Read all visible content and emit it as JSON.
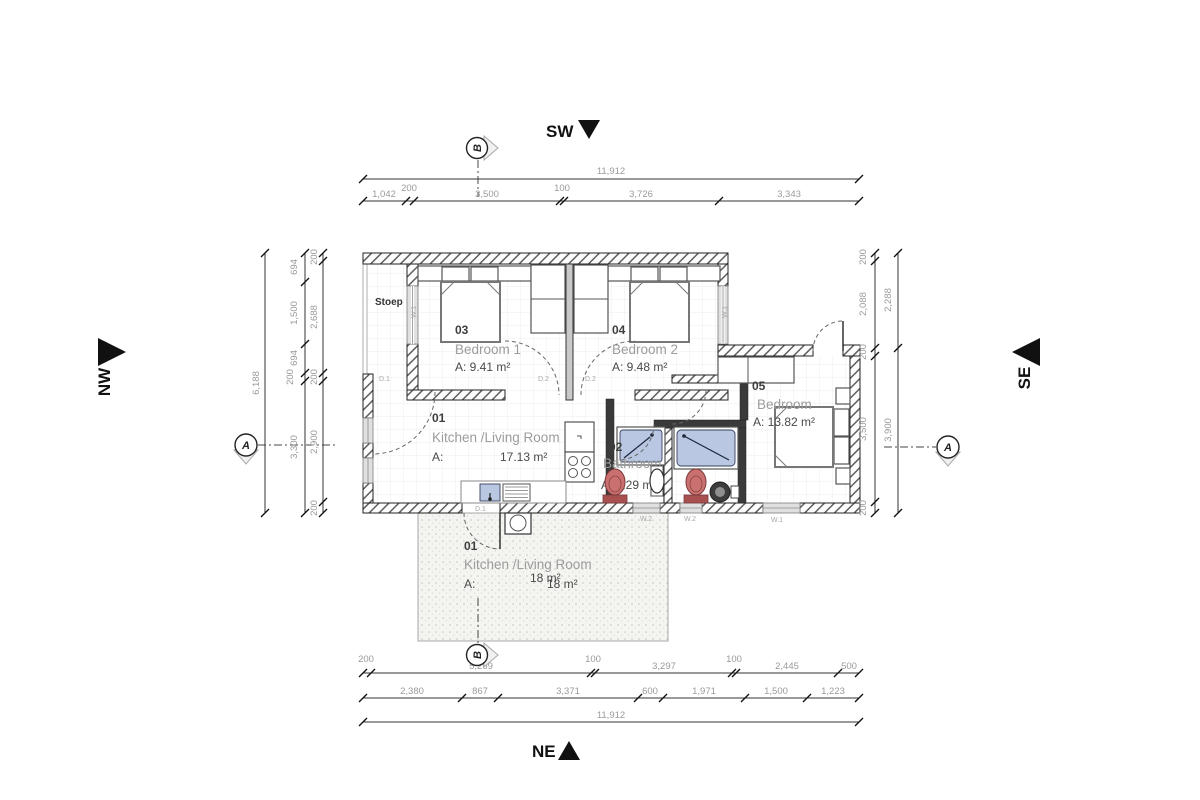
{
  "compass": {
    "sw": "SW",
    "ne": "NE",
    "nw": "NW",
    "se": "SE"
  },
  "section_markers": {
    "top": "B",
    "bottom": "B",
    "left": "A",
    "right": "A"
  },
  "dims": {
    "top": {
      "total": "11,912",
      "minor": [
        "200",
        "100"
      ],
      "segments": [
        "1,042",
        "3,500",
        "3,726",
        "3,343"
      ]
    },
    "bottom": {
      "row1": [
        "200",
        "5,269",
        "100",
        "3,297",
        "100",
        "2,445",
        "500"
      ],
      "row2": [
        "2,380",
        "867",
        "3,371",
        "600",
        "1,971",
        "1,500",
        "1,223"
      ],
      "total": "11,912"
    },
    "left": {
      "total": "6,188",
      "mid": [
        "694",
        "1,500",
        "694",
        "200",
        "3,300"
      ],
      "inner": [
        "200",
        "2,688",
        "200",
        "2,900",
        "200"
      ]
    },
    "right": {
      "inner": [
        "200",
        "2,088",
        "200",
        "3,500",
        "200"
      ],
      "outer": [
        "2,288",
        "3,900"
      ]
    }
  },
  "rooms": {
    "kitchen": {
      "number": "01",
      "name": "Kitchen /Living Room",
      "area_prefix": "A:",
      "area": "17.13 m²"
    },
    "bathroom": {
      "number": "02",
      "name": "Bathroom",
      "area": "A: 3.29 m²"
    },
    "bedroom1": {
      "number": "03",
      "name": "Bedroom 1",
      "area": "A:  9.41 m²"
    },
    "bedroom2": {
      "number": "04",
      "name": "Bedroom 2",
      "area": "A:  9.48 m²"
    },
    "bedroom5": {
      "number": "05",
      "name": "Bedroom",
      "area": "A: 13.82 m²"
    },
    "stoep": {
      "name": "Stoep"
    },
    "patio": {
      "number": "01",
      "name": "Kitchen /Living Room",
      "area_prefix": "A:",
      "area": "18 m²",
      "area_duplicate": "18 m²"
    }
  },
  "openings": {
    "door_stoep": "D.1",
    "door_bed1": "D.2",
    "door_bed2": "D.2",
    "door_patio": "D.1",
    "window_stoep": "W.1",
    "window_bed2": "W.1",
    "window_bath": "W.2",
    "window_shower": "W.2",
    "window_bed5": "W.1"
  }
}
